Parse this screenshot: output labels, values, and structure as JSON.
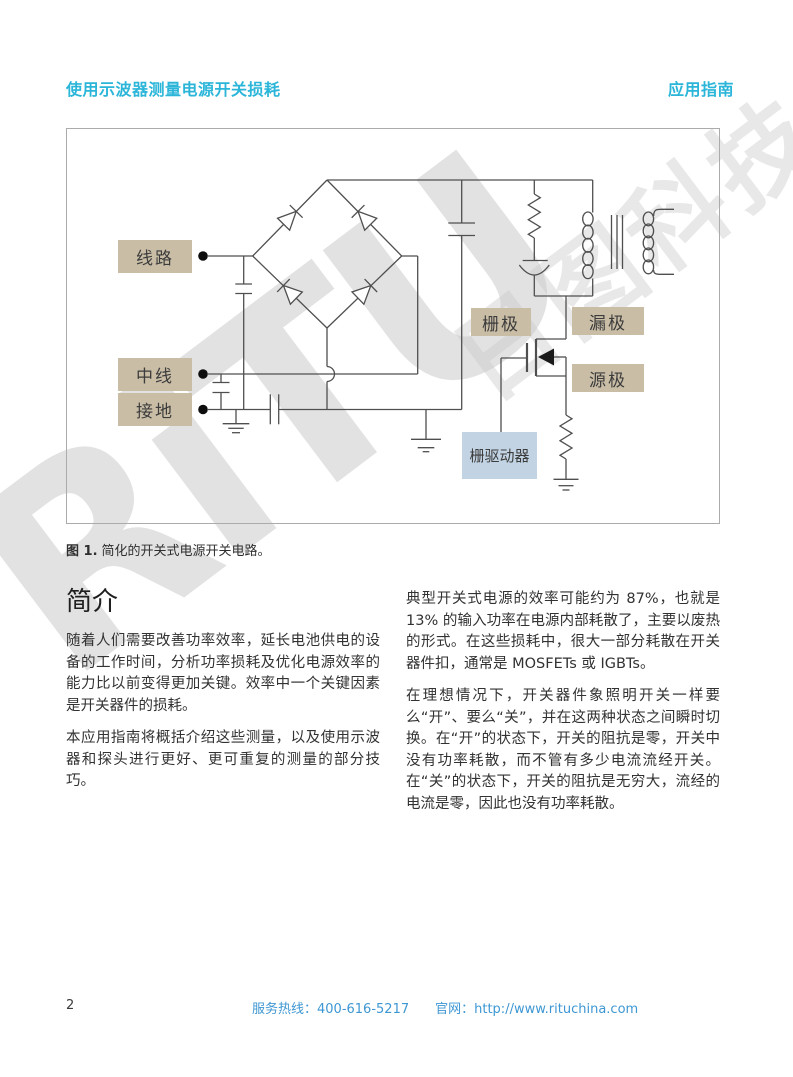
{
  "header": {
    "title": "使用示波器测量电源开关损耗",
    "doc_type": "应用指南"
  },
  "watermark": {
    "logo": "RiTU",
    "company": "日图科技"
  },
  "figure": {
    "caption_label": "图 1.",
    "caption_text": "简化的开关式电源开关电路。",
    "labels": {
      "line": "线路",
      "neutral": "中线",
      "ground": "接地",
      "gate": "栅极",
      "drain": "漏极",
      "source": "源极",
      "gate_driver": "栅驱动器"
    }
  },
  "intro": {
    "heading": "简介",
    "p1": "随着人们需要改善功率效率，延长电池供电的设备的工作时间，分析功率损耗及优化电源效率的能力比以前变得更加关键。效率中一个关键因素是开关器件的损耗。",
    "p2": "本应用指南将概括介绍这些测量，以及使用示波器和探头进行更好、更可重复的测量的部分技巧。"
  },
  "right_col": {
    "p1": "典型开关式电源的效率可能约为 87%，也就是 13% 的输入功率在电源内部耗散了，主要以废热的形式。在这些损耗中，很大一部分耗散在开关器件扣，通常是 MOSFETs 或 IGBTs。",
    "p2": "在理想情况下，开关器件象照明开关一样要么“开”、要么“关”，并在这两种状态之间瞬时切换。在“开”的状态下，开关的阻抗是零，开关中没有功率耗散，而不管有多少电流流经开关。在“关”的状态下，开关的阻抗是无穷大，流经的电流是零，因此也没有功率耗散。"
  },
  "footer": {
    "page_number": "2",
    "hotline_label": "服务热线：",
    "hotline_number": "400-616-5217",
    "site_label": "官网：",
    "site_url": "http://www.rituchina.com"
  },
  "colors": {
    "accent_teal": "#2bb6d9",
    "footer_link_blue": "#3e97d3",
    "label_tan": "#c9bda6",
    "gate_driver_blue": "#c2d3e3",
    "wire_gray": "#4f4f4f"
  }
}
